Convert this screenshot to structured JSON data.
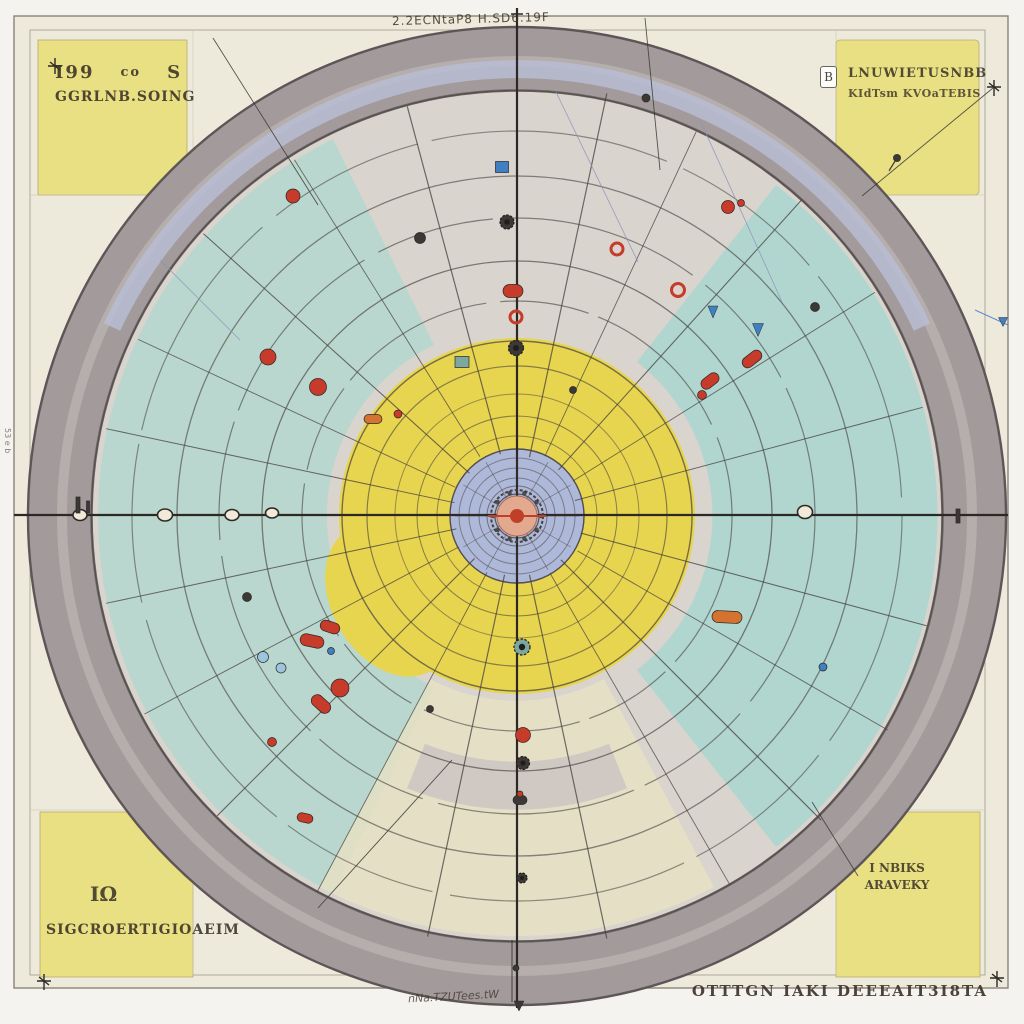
{
  "labels": {
    "top_center": "2.2ECNtaP8 H.SD6.19F",
    "bottom_outside": "OTTTGN IAKI DEEEAIT3I8TA",
    "bottom_scrawl": "nNa.TZUTees.tW",
    "left_edge": "53 e b"
  },
  "corners": {
    "tl1": "I99",
    "tl1b": "co",
    "tl1c": "S",
    "tl2": "GGRLNB.SOING",
    "tr1": "LNUWIETUSNBB",
    "tr2": "KIdTsm KVOaTEBIS",
    "badge": "B",
    "bl1": "IΩ",
    "bl2": "SIGCROERTIGIOAEIM",
    "br1": "I NBIKS",
    "br2": "ARAVEKY"
  },
  "colors": {
    "page_bg": "#f4f3ef",
    "panel_bg": "#edeadb",
    "corner_square": "#e9e083",
    "ring": "#a39a9b",
    "ring_edge": "#5d5557",
    "interior": "#d9d4ce",
    "teal": "#b7d7cd",
    "teal_right": "#afd6cf",
    "olive": "#e5e1c3",
    "band_gray": "#cdc6c2",
    "lavender": "#b8bdd3",
    "yellow": "#e8d54f",
    "blue_disc": "#aeb8d8",
    "hub": "#e2a98f",
    "hub_core": "#bf3f28",
    "sketch": "#46403d",
    "axis": "#2c2826",
    "grid": "#c8c3b0",
    "red": "#c63b2a",
    "orange": "#d4722f",
    "blue": "#3f7fc2",
    "lblue": "#9cc6dd",
    "bluish": "#8a93bd",
    "dark": "#3c3836",
    "teal_m": "#7ca8a0",
    "knob": "#f2e9d8",
    "text": "#3a3127",
    "frame": "#8a8478"
  },
  "geometry": {
    "center": {
      "x": 517,
      "y": 516
    },
    "outer_r": 489,
    "ring_inner_r": 426,
    "rings": [
      [
        8,
        1,
        0.8,
        ""
      ],
      [
        14,
        1,
        0.7,
        ""
      ],
      [
        22,
        1.2,
        0.8,
        ""
      ],
      [
        30,
        1,
        0.6,
        ""
      ],
      [
        38,
        1,
        0.55,
        ""
      ],
      [
        48,
        1,
        0.5,
        ""
      ],
      [
        58,
        1,
        0.5,
        ""
      ],
      [
        67,
        1.4,
        0.8,
        ""
      ],
      [
        80,
        1,
        0.55,
        ""
      ],
      [
        100,
        1,
        0.6,
        ""
      ],
      [
        122,
        1,
        0.5,
        ""
      ],
      [
        150,
        1.2,
        0.6,
        ""
      ],
      [
        175,
        1.4,
        0.7,
        ""
      ],
      [
        215,
        1.2,
        0.6,
        "160 14 90 10"
      ],
      [
        255,
        1.3,
        0.65,
        ""
      ],
      [
        298,
        1.2,
        0.6,
        "200 16 120 12"
      ],
      [
        340,
        1.3,
        0.6,
        ""
      ],
      [
        385,
        1.2,
        0.55,
        "240 18 160 14"
      ],
      [
        425,
        1.6,
        0.8,
        ""
      ]
    ],
    "spokes": [
      [
        15,
        66,
        424,
        1.1
      ],
      [
        30,
        70,
        428,
        0.9
      ],
      [
        45,
        62,
        430,
        1.2
      ],
      [
        60,
        66,
        426,
        0.9
      ],
      [
        78,
        60,
        432,
        1.2
      ],
      [
        102,
        60,
        430,
        1.2
      ],
      [
        118,
        64,
        426,
        0.9
      ],
      [
        135,
        60,
        424,
        1.1
      ],
      [
        152,
        66,
        422,
        0.9
      ],
      [
        168,
        62,
        420,
        1.0
      ],
      [
        192,
        64,
        420,
        1.0
      ],
      [
        205,
        68,
        418,
        0.9
      ],
      [
        222,
        64,
        422,
        1.1
      ],
      [
        238,
        70,
        420,
        0.9
      ],
      [
        255,
        64,
        424,
        1.2
      ],
      [
        282,
        60,
        432,
        1.2
      ],
      [
        295,
        66,
        424,
        0.9
      ],
      [
        312,
        62,
        426,
        1.1
      ],
      [
        328,
        66,
        422,
        0.9
      ],
      [
        345,
        60,
        420,
        1.0
      ]
    ],
    "hub": {
      "spoke_step": 30,
      "r0": 10,
      "r1": 62,
      "dot_count": 10,
      "dot_r": 24,
      "dot_size": 2.2
    },
    "markers": [
      {
        "x": 293,
        "y": 196,
        "t": "dot",
        "c": "red",
        "w": 14
      },
      {
        "x": 513,
        "y": 291,
        "t": "capsule",
        "c": "red",
        "w": 20,
        "h": 13,
        "r": 0
      },
      {
        "x": 516,
        "y": 317,
        "t": "ring",
        "c": "red",
        "w": 12
      },
      {
        "x": 268,
        "y": 357,
        "t": "dot",
        "c": "red",
        "w": 16
      },
      {
        "x": 318,
        "y": 387,
        "t": "dot",
        "c": "red",
        "w": 17
      },
      {
        "x": 373,
        "y": 419,
        "t": "capsule",
        "c": "orange",
        "w": 18,
        "h": 9,
        "r": 0
      },
      {
        "x": 398,
        "y": 414,
        "t": "dot",
        "c": "red",
        "w": 8
      },
      {
        "x": 617,
        "y": 249,
        "t": "ring",
        "c": "red",
        "w": 12
      },
      {
        "x": 678,
        "y": 290,
        "t": "ring",
        "c": "red",
        "w": 13
      },
      {
        "x": 728,
        "y": 207,
        "t": "dot",
        "c": "red",
        "w": 13
      },
      {
        "x": 741,
        "y": 203,
        "t": "dot",
        "c": "red",
        "w": 7
      },
      {
        "x": 752,
        "y": 359,
        "t": "capsule",
        "c": "red",
        "w": 22,
        "h": 11,
        "r": -38
      },
      {
        "x": 710,
        "y": 381,
        "t": "capsule",
        "c": "red",
        "w": 20,
        "h": 11,
        "r": -38
      },
      {
        "x": 702,
        "y": 395,
        "t": "dot",
        "c": "red",
        "w": 9
      },
      {
        "x": 713,
        "y": 312,
        "t": "drop",
        "c": "blue",
        "w": 10,
        "h": 12
      },
      {
        "x": 758,
        "y": 330,
        "t": "drop",
        "c": "blue",
        "w": 11,
        "h": 13
      },
      {
        "x": 502,
        "y": 167,
        "t": "rect",
        "c": "blue",
        "w": 13,
        "h": 11,
        "r": 0
      },
      {
        "x": 330,
        "y": 627,
        "t": "capsule",
        "c": "red",
        "w": 20,
        "h": 11,
        "r": 18
      },
      {
        "x": 312,
        "y": 641,
        "t": "capsule",
        "c": "red",
        "w": 24,
        "h": 12,
        "r": 12
      },
      {
        "x": 331,
        "y": 651,
        "t": "dot",
        "c": "blue",
        "w": 7
      },
      {
        "x": 263,
        "y": 657,
        "t": "dot",
        "c": "lblue",
        "w": 11
      },
      {
        "x": 281,
        "y": 668,
        "t": "dot",
        "c": "lblue",
        "w": 10
      },
      {
        "x": 340,
        "y": 688,
        "t": "dot",
        "c": "red",
        "w": 18
      },
      {
        "x": 321,
        "y": 704,
        "t": "capsule",
        "c": "red",
        "w": 22,
        "h": 12,
        "r": 42
      },
      {
        "x": 272,
        "y": 742,
        "t": "dot",
        "c": "red",
        "w": 9
      },
      {
        "x": 305,
        "y": 818,
        "t": "capsule",
        "c": "red",
        "w": 16,
        "h": 9,
        "r": 12
      },
      {
        "x": 727,
        "y": 617,
        "t": "capsule",
        "c": "orange",
        "w": 30,
        "h": 12,
        "r": 3
      },
      {
        "x": 823,
        "y": 667,
        "t": "dot",
        "c": "blue",
        "w": 8
      },
      {
        "x": 522,
        "y": 647,
        "t": "gear",
        "c": "teal_m",
        "w": 16
      },
      {
        "x": 523,
        "y": 735,
        "t": "dot",
        "c": "red",
        "w": 15
      },
      {
        "x": 523,
        "y": 763,
        "t": "gear",
        "c": "dark",
        "w": 13
      },
      {
        "x": 520,
        "y": 800,
        "t": "capsule",
        "c": "dark",
        "w": 14,
        "h": 9,
        "r": 0
      },
      {
        "x": 520,
        "y": 794,
        "t": "dot",
        "c": "red",
        "w": 6
      },
      {
        "x": 80,
        "y": 515,
        "t": "knob",
        "w": 14,
        "h": 11
      },
      {
        "x": 165,
        "y": 515,
        "t": "knob",
        "w": 15,
        "h": 12
      },
      {
        "x": 232,
        "y": 515,
        "t": "knob",
        "w": 14,
        "h": 11
      },
      {
        "x": 272,
        "y": 513,
        "t": "knob",
        "w": 13,
        "h": 10
      },
      {
        "x": 805,
        "y": 512,
        "t": "knob",
        "w": 15,
        "h": 13
      },
      {
        "x": 420,
        "y": 238,
        "t": "dot",
        "c": "dark",
        "w": 11
      },
      {
        "x": 507,
        "y": 222,
        "t": "gear",
        "c": "dark",
        "w": 14
      },
      {
        "x": 516,
        "y": 348,
        "t": "gear",
        "c": "dark",
        "w": 15
      },
      {
        "x": 462,
        "y": 362,
        "t": "rect",
        "c": "teal_m",
        "w": 14,
        "h": 11,
        "r": 0
      },
      {
        "x": 815,
        "y": 307,
        "t": "dot",
        "c": "dark",
        "w": 9
      },
      {
        "x": 897,
        "y": 158,
        "t": "pin",
        "c": "dark",
        "w": 8
      },
      {
        "x": 646,
        "y": 98,
        "t": "dot",
        "c": "dark",
        "w": 8
      },
      {
        "x": 573,
        "y": 390,
        "t": "dot",
        "c": "dark",
        "w": 7
      },
      {
        "x": 247,
        "y": 597,
        "t": "dot",
        "c": "dark",
        "w": 9
      },
      {
        "x": 430,
        "y": 709,
        "t": "dot",
        "c": "dark",
        "w": 7
      },
      {
        "x": 522,
        "y": 878,
        "t": "gear",
        "c": "dark",
        "w": 10
      },
      {
        "x": 516,
        "y": 968,
        "t": "dot",
        "c": "dark",
        "w": 6
      },
      {
        "x": 958,
        "y": 516,
        "t": "rect",
        "c": "dark",
        "w": 4,
        "h": 14,
        "r": 0
      },
      {
        "x": 78,
        "y": 505,
        "t": "rect",
        "c": "dark",
        "w": 4,
        "h": 16,
        "r": 0
      },
      {
        "x": 88,
        "y": 507,
        "t": "rect",
        "c": "dark",
        "w": 3,
        "h": 12,
        "r": 0
      },
      {
        "x": 1003,
        "y": 322,
        "t": "drop",
        "c": "blue",
        "w": 9,
        "h": 9
      },
      {
        "x": 519,
        "y": 1006,
        "t": "drop",
        "c": "dark",
        "w": 10,
        "h": 10
      }
    ],
    "lines": [
      [
        213,
        38,
        318,
        205,
        "dark",
        0.9
      ],
      [
        993,
        88,
        862,
        196,
        "dark",
        0.9
      ],
      [
        318,
        908,
        452,
        760,
        "dark",
        0.9
      ],
      [
        812,
        802,
        858,
        876,
        "dark",
        0.9
      ],
      [
        645,
        18,
        660,
        170,
        "dark",
        0.9
      ],
      [
        975,
        310,
        1008,
        325,
        "blue",
        1.0
      ],
      [
        700,
        120,
        782,
        302,
        "bluish",
        0.8
      ],
      [
        556,
        92,
        638,
        262,
        "bluish",
        0.8
      ],
      [
        160,
        260,
        240,
        340,
        "bluish",
        0.8
      ]
    ]
  }
}
